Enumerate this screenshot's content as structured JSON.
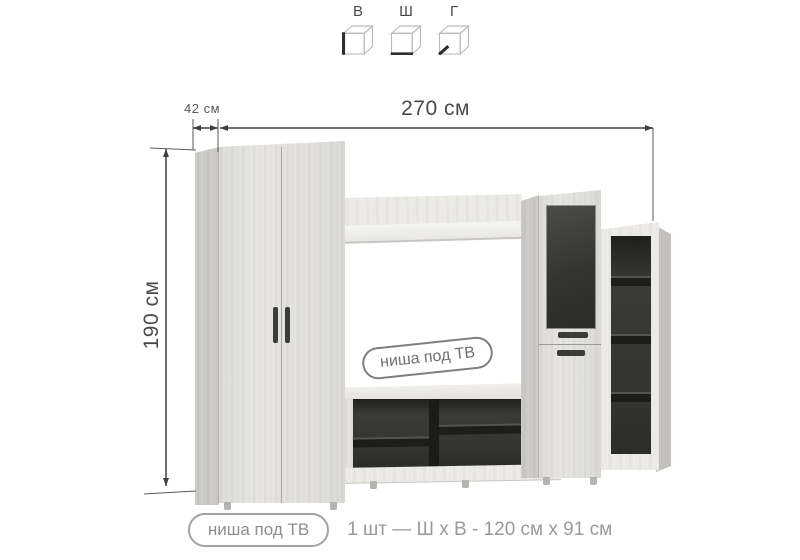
{
  "legend": {
    "items": [
      {
        "label": "В",
        "icon": "cube-height-icon"
      },
      {
        "label": "Ш",
        "icon": "cube-width-icon"
      },
      {
        "label": "Г",
        "icon": "cube-depth-icon"
      }
    ]
  },
  "dimensions": {
    "depth": "42 см",
    "width": "270 см",
    "height": "190 см"
  },
  "niche_label": "ниша под ТВ",
  "caption": {
    "pill": "ниша под ТВ",
    "spec": "1 шт — Ш х В - 120 см х 91 см"
  },
  "colors": {
    "wood_light": "#e4e3df",
    "wood_side": "#c8c7c3",
    "dark_glass": "#333331",
    "interior_dark": "#2e2e2c",
    "dimension_line": "#3f3f3f",
    "caption_text": "#9a9a9a"
  }
}
